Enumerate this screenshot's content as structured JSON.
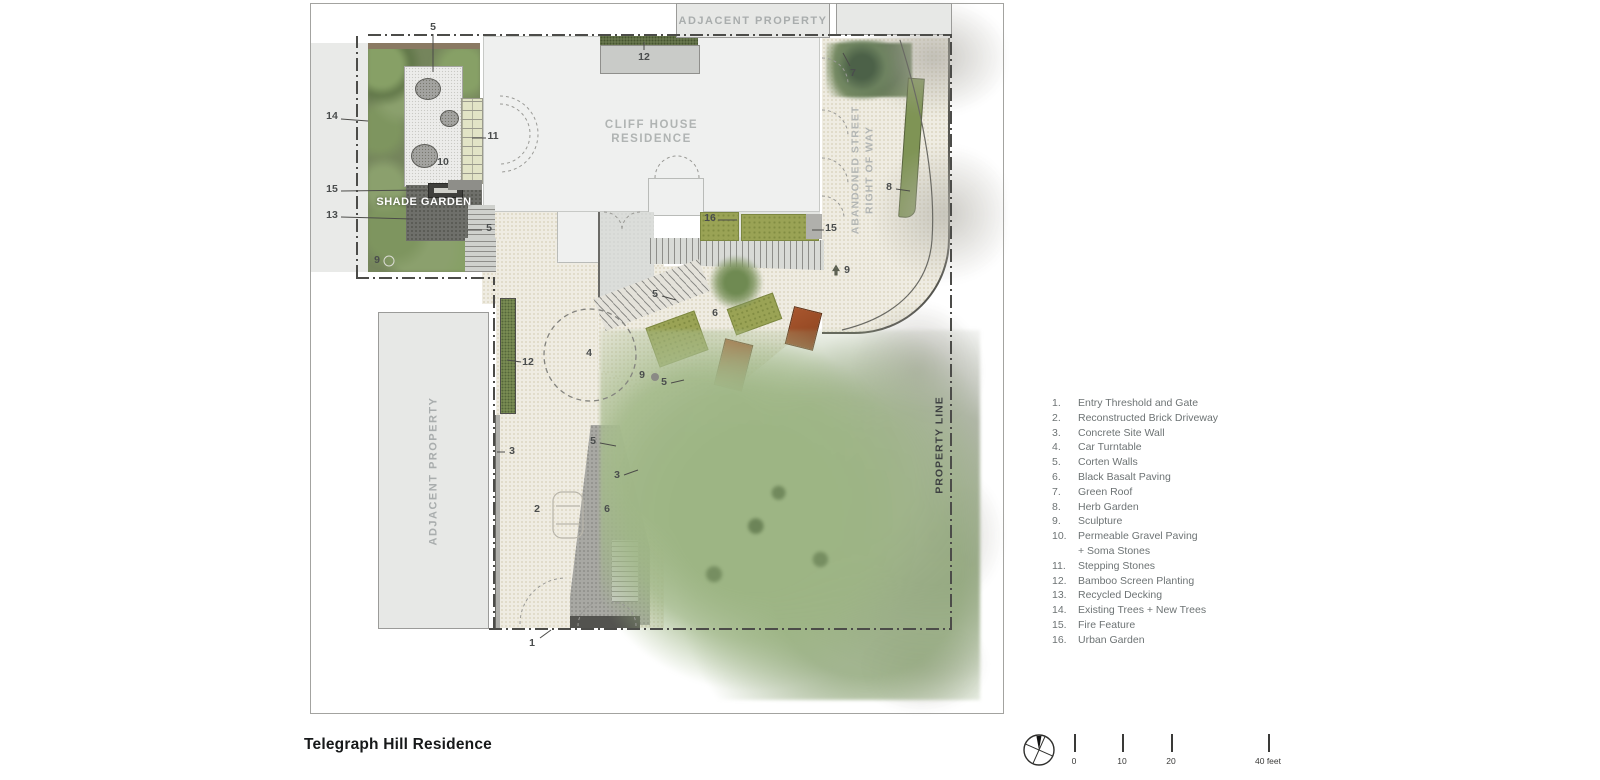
{
  "title": "Telegraph Hill Residence",
  "palette": {
    "corten": "#a8562e",
    "olive": "#9aa355",
    "shade_green": "#75855c",
    "paving_beige": "#efece2",
    "basalt_gray": "#a8a8a3",
    "gray_box": "#e7e8e6",
    "legend_text": "#6d7374",
    "line_dark": "#4c4c49"
  },
  "plan": {
    "labels": {
      "adjacent_property_top": "ADJACENT PROPERTY",
      "adjacent_property_left": "ADJACENT PROPERTY",
      "cliff_house_line1": "CLIFF HOUSE",
      "cliff_house_line2": "RESIDENCE",
      "shade_garden": "SHADE GARDEN",
      "abandoned_street_line1": "ABANDONED STREET",
      "abandoned_street_line2": "RIGHT OF WAY",
      "property_line": "PROPERTY LINE"
    },
    "callouts": [
      {
        "n": "5",
        "x": 433,
        "y": 27,
        "leader": [
          433,
          34,
          433,
          72
        ]
      },
      {
        "n": "12",
        "x": 644,
        "y": 57,
        "leader": [
          644,
          50,
          644,
          42
        ]
      },
      {
        "n": "7",
        "x": 853,
        "y": 73,
        "leader": [
          850,
          66,
          843,
          53
        ]
      },
      {
        "n": "14",
        "x": 332,
        "y": 116,
        "leader": [
          341,
          119,
          368,
          121
        ]
      },
      {
        "n": "11",
        "x": 493,
        "y": 136,
        "leader": [
          486,
          138,
          472,
          138
        ]
      },
      {
        "n": "10",
        "x": 443,
        "y": 162
      },
      {
        "n": "15",
        "x": 332,
        "y": 189,
        "leader": [
          341,
          191,
          427,
          190
        ]
      },
      {
        "n": "13",
        "x": 332,
        "y": 215,
        "leader": [
          341,
          217,
          413,
          219
        ]
      },
      {
        "n": "5",
        "x": 489,
        "y": 228,
        "leader": [
          482,
          230,
          468,
          230
        ]
      },
      {
        "n": "8",
        "x": 889,
        "y": 187,
        "leader": [
          896,
          189,
          910,
          191
        ]
      },
      {
        "n": "16",
        "x": 710,
        "y": 218,
        "leader": [
          718,
          220,
          737,
          220
        ]
      },
      {
        "n": "15",
        "x": 831,
        "y": 228,
        "leader": [
          824,
          230,
          812,
          230
        ]
      },
      {
        "n": "9",
        "x": 847,
        "y": 270
      },
      {
        "n": "9",
        "x": 377,
        "y": 260
      },
      {
        "n": "5",
        "x": 655,
        "y": 294,
        "leader": [
          662,
          296,
          676,
          300
        ]
      },
      {
        "n": "6",
        "x": 715,
        "y": 313
      },
      {
        "n": "12",
        "x": 528,
        "y": 362,
        "leader": [
          521,
          362,
          507,
          360
        ]
      },
      {
        "n": "4",
        "x": 589,
        "y": 353
      },
      {
        "n": "9",
        "x": 642,
        "y": 375
      },
      {
        "n": "5",
        "x": 664,
        "y": 382,
        "leader": [
          671,
          383,
          684,
          380
        ]
      },
      {
        "n": "3",
        "x": 512,
        "y": 451,
        "leader": [
          505,
          452,
          497,
          452
        ]
      },
      {
        "n": "5",
        "x": 593,
        "y": 441,
        "leader": [
          600,
          443,
          616,
          446
        ]
      },
      {
        "n": "3",
        "x": 617,
        "y": 475,
        "leader": [
          624,
          475,
          638,
          470
        ]
      },
      {
        "n": "2",
        "x": 537,
        "y": 509
      },
      {
        "n": "6",
        "x": 607,
        "y": 509
      },
      {
        "n": "1",
        "x": 532,
        "y": 643,
        "leader": [
          540,
          638,
          551,
          630
        ]
      }
    ],
    "markers": [
      {
        "type": "dot",
        "x": 655,
        "y": 377
      },
      {
        "type": "sculpture",
        "x": 836,
        "y": 270
      },
      {
        "type": "ring",
        "x": 389,
        "y": 261
      }
    ]
  },
  "legend": {
    "items": [
      {
        "num": "1.",
        "label": "Entry Threshold and Gate"
      },
      {
        "num": "2.",
        "label": "Reconstructed Brick Driveway"
      },
      {
        "num": "3.",
        "label": "Concrete Site Wall"
      },
      {
        "num": "4.",
        "label": "Car Turntable"
      },
      {
        "num": "5.",
        "label": "Corten Walls"
      },
      {
        "num": "6.",
        "label": "Black Basalt Paving"
      },
      {
        "num": "7.",
        "label": "Green Roof"
      },
      {
        "num": "8.",
        "label": "Herb Garden"
      },
      {
        "num": "9.",
        "label": "Sculpture"
      },
      {
        "num": "10.",
        "label": "Permeable Gravel Paving",
        "label2": "+ Soma Stones"
      },
      {
        "num": "11.",
        "label": "Stepping Stones"
      },
      {
        "num": "12.",
        "label": "Bamboo Screen Planting"
      },
      {
        "num": "13.",
        "label": "Recycled Decking"
      },
      {
        "num": "14.",
        "label": "Existing Trees + New Trees"
      },
      {
        "num": "15.",
        "label": "Fire Feature"
      },
      {
        "num": "16.",
        "label": "Urban Garden"
      }
    ]
  },
  "scale_bar": {
    "ticks": [
      {
        "label": "0",
        "x": 1074
      },
      {
        "label": "10",
        "x": 1122
      },
      {
        "label": "20",
        "x": 1171
      },
      {
        "label": "40 feet",
        "x": 1268
      }
    ]
  }
}
